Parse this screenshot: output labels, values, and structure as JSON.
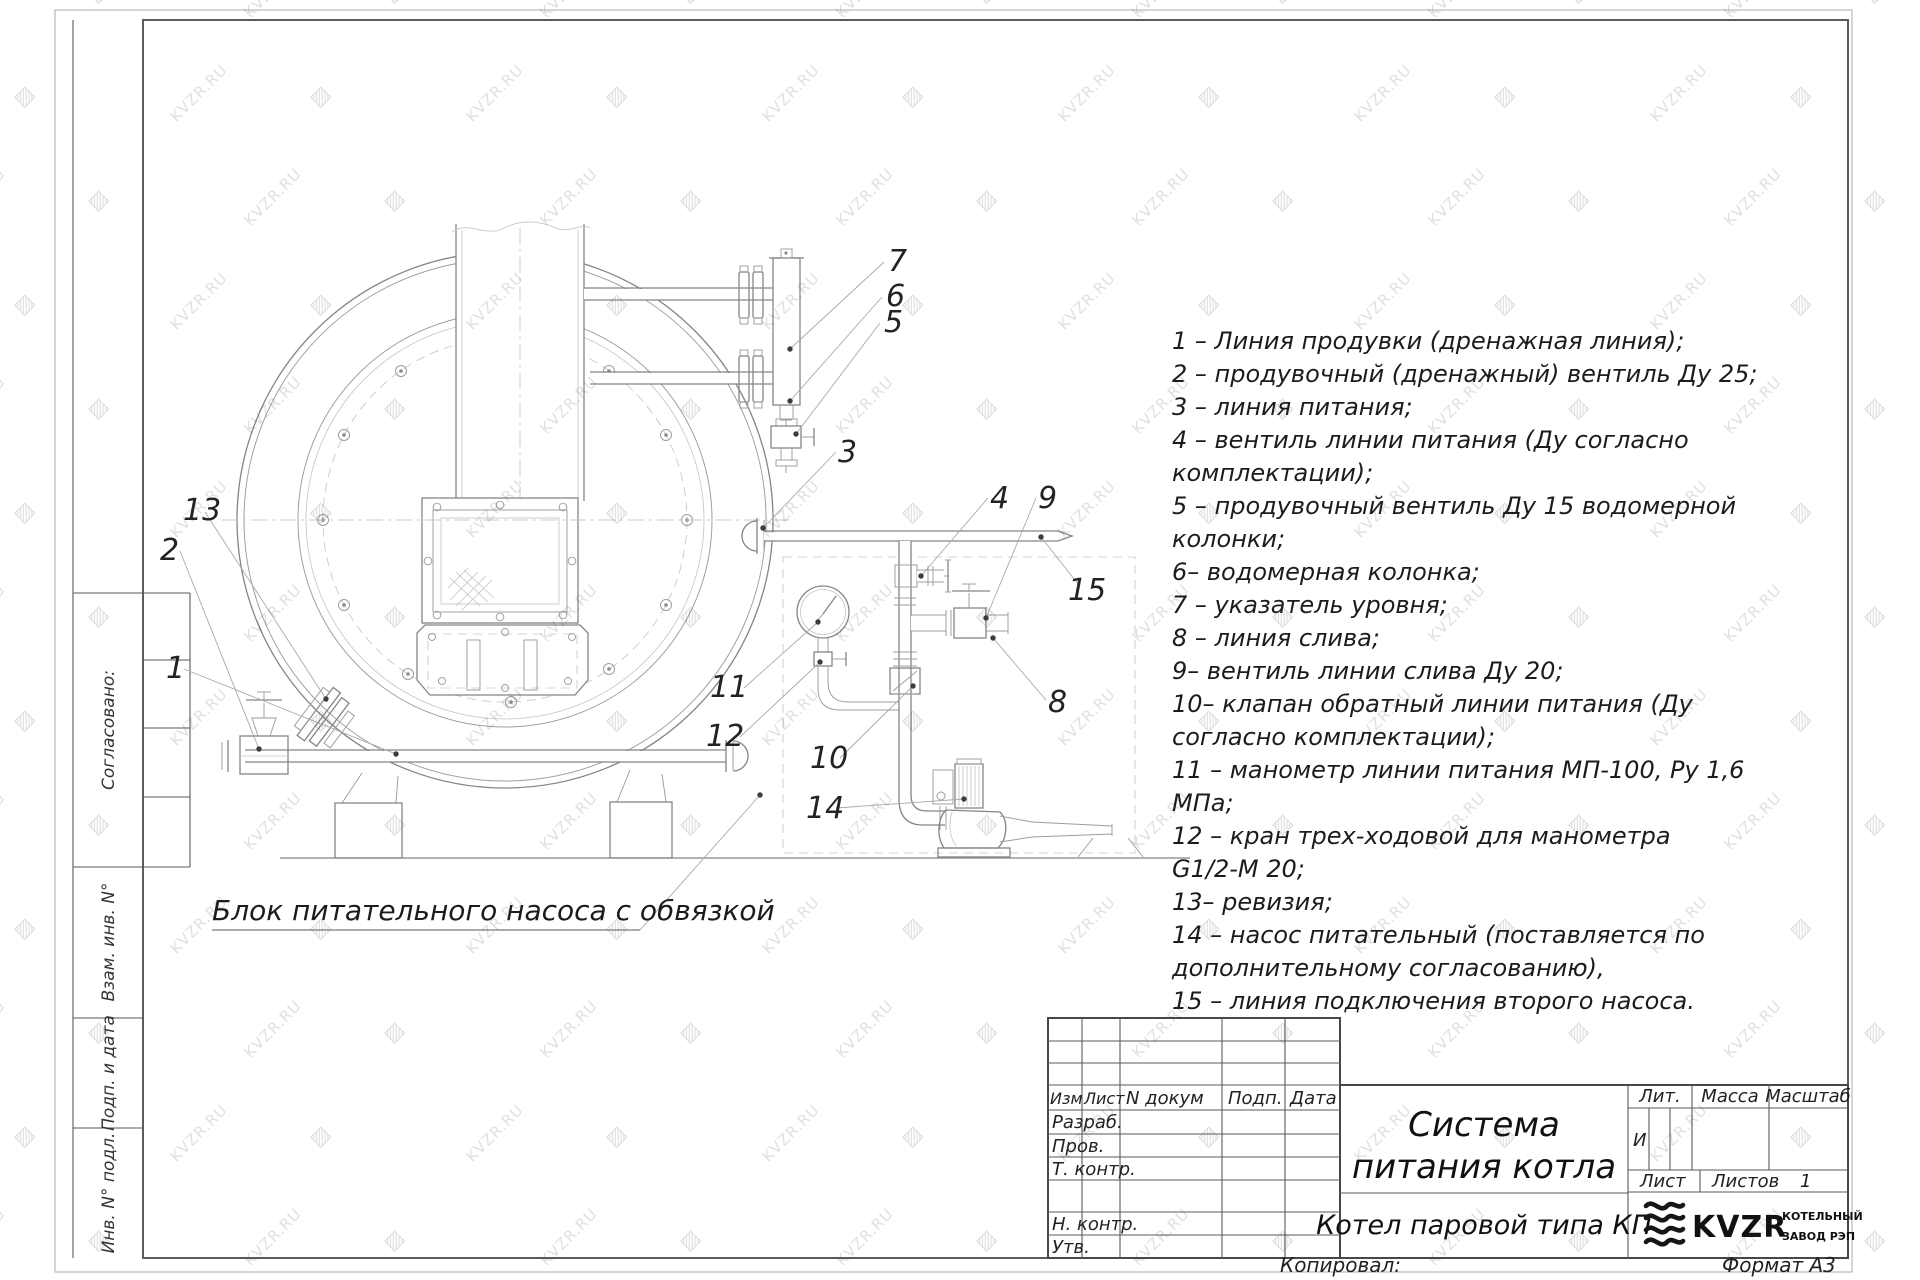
{
  "watermark": {
    "text": "KVZR.RU",
    "icon": "▨"
  },
  "frame": {
    "copied_by": "Копировал:",
    "format": "Формат А3"
  },
  "side_strip": {
    "agreed": "Согласовано:",
    "replace_inv": "Взам. инв. N°",
    "sign_date": "Подп. и дата",
    "inv_orig": "Инв. N° подл."
  },
  "drawing": {
    "caption": "Блок питательного насоса с обвязкой",
    "callouts": {
      "c1": "1",
      "c2": "2",
      "c3": "3",
      "c4": "4",
      "c5": "5",
      "c6": "6",
      "c7": "7",
      "c8": "8",
      "c9": "9",
      "c10": "10",
      "c11": "11",
      "c12": "12",
      "c13": "13",
      "c14": "14",
      "c15": "15"
    }
  },
  "legend": {
    "lines": [
      "1 –  Линия продувки  (дренажная линия);",
      "2 –  продувочный  (дренажный)  вентиль  Ду 25;",
      "3 –  линия питания;",
      "4 –  вентиль линии питания  (Ду согласно",
      "комплектации);",
      "5 –  продувочный вентиль Ду 15  водомерной",
      "колонки;",
      "6–  водомерная колонка;",
      "7 –  указатель уровня;",
      "8 –  линия слива;",
      "9–  вентиль линии слива Ду 20;",
      "10–  клапан обратный линии питания  (Ду",
      "согласно комплектации);",
      "11 –  манометр линии питания МП-100, Ру 1,6",
      "МПа;",
      "12 –  кран трех-ходовой для манометра",
      "G1/2-М 20;",
      "13–  ревизия;",
      "14 –  насос питательный  (поставляется по",
      "дополнительному согласованию),",
      "15 –  линия подключения второго насоса."
    ]
  },
  "title_block": {
    "cols": {
      "izm": "Изм",
      "list": "Лист",
      "ndoc": "N докум",
      "podp": "Подп.",
      "data": "Дата"
    },
    "rows": {
      "razrab": "Разраб.",
      "prov": "Пров.",
      "tkontr": "Т. контр.",
      "nkontr": "Н. контр.",
      "utv": "Утв."
    },
    "title_line1": "Система",
    "title_line2": "питания котла",
    "subtitle": "Котел паровой типа КП",
    "lit_label": "Лит.",
    "lit_value": "И",
    "mass_label": "Масса",
    "scale_label": "Масштаб",
    "sheet_label": "Лист",
    "sheets_label": "Листов",
    "sheets_value": "1",
    "logo_text": "KVZR",
    "logo_line1": "КОТЕЛЬНЫЙ",
    "logo_line2": "ЗАВОД РЭП"
  }
}
